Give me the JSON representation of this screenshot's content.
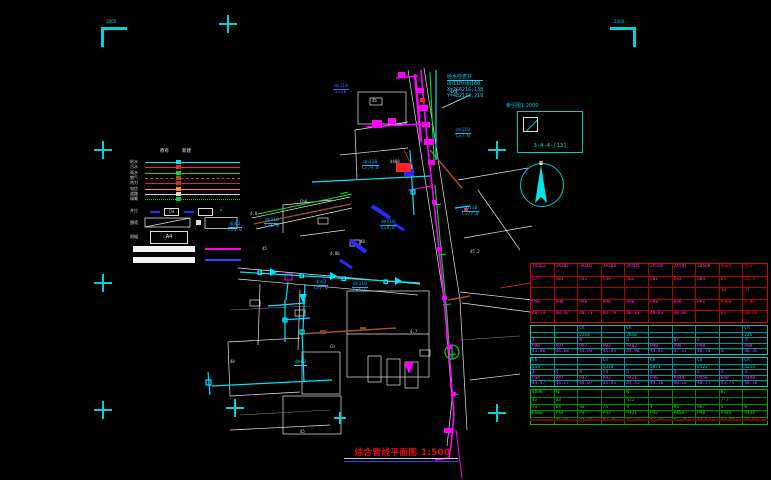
{
  "title": {
    "text": "综合管线平面图 1:500"
  },
  "corner_marks": {
    "tl_text": "2000",
    "tr_text": "2000"
  },
  "index_box": {
    "caption": "索引图1:2000",
    "code": "3-4-4-[13]"
  },
  "coord_block": {
    "line1": "给水检查井",
    "line2": "dn110×dn160",
    "line3": "X=266216.138",
    "line4": "Y=482178.218"
  },
  "colors": {
    "register": "#00d5d5",
    "water": "#ff00ff",
    "existing": "#00e5ff",
    "storm": "#00dd30",
    "table_red": "#e00000",
    "table_cyan": "#00cccc",
    "table_green": "#00bb00",
    "label_blue": "#4466ff"
  },
  "legend": {
    "col_headers": [
      "原有",
      "新建"
    ],
    "rows": [
      {
        "label": "给水",
        "color": "#00e5ff",
        "dash": "solid"
      },
      {
        "label": "污水",
        "color": "#ff2020",
        "dash": "solid"
      },
      {
        "label": "雨水",
        "color": "#00dd30",
        "dash": "solid"
      },
      {
        "label": "燃气",
        "color": "#b05020",
        "dash": "dashed"
      },
      {
        "label": "热力",
        "color": "#d03030",
        "dash": "solid"
      },
      {
        "label": "电信",
        "color": "#ff9020",
        "dash": "solid"
      },
      {
        "label": "道路",
        "color": "#d8d8d8",
        "dash": "solid"
      },
      {
        "label": "绿篱",
        "color": "#00cc40",
        "dash": "dotted"
      }
    ],
    "symbol_row_label": "井位",
    "symbol_box1": "CH",
    "symbol_box2": "",
    "symbol_glyph": "£",
    "wall_label": "围墙",
    "frame_label": "图幅",
    "frame_code": "A4"
  },
  "map_labels": [
    {
      "t": "dn110",
      "s": "L=20",
      "x": 333,
      "y": 84,
      "c": "#4466ff"
    },
    {
      "t": "dn110",
      "s": "L=7.0",
      "x": 455,
      "y": 128,
      "c": "#00b7ff"
    },
    {
      "t": "dn110",
      "s": "L=79.0",
      "x": 362,
      "y": 160,
      "c": "#00b7ff"
    },
    {
      "t": "dn110",
      "s": "L=77.8",
      "x": 462,
      "y": 206,
      "c": "#00b7ff"
    },
    {
      "t": "dn63",
      "s": "L=3.0",
      "x": 228,
      "y": 222,
      "c": "#00b7ff"
    },
    {
      "t": "dn110",
      "s": "L=5.0",
      "x": 264,
      "y": 218,
      "c": "#00b7ff"
    },
    {
      "t": "dn110",
      "s": "L=4.0",
      "x": 380,
      "y": 220,
      "c": "#00b7ff"
    },
    {
      "t": "dn63",
      "s": "L=7.0",
      "x": 314,
      "y": 280,
      "c": "#00b7ff"
    },
    {
      "t": "dn110",
      "s": "L=5.0",
      "x": 352,
      "y": 282,
      "c": "#00b7ff"
    },
    {
      "t": "dn63",
      "s": "",
      "x": 294,
      "y": 360,
      "c": "#00e5ff"
    }
  ],
  "map_texts": [
    {
      "t": "4.8",
      "x": 250,
      "y": 212
    },
    {
      "t": "Ch8",
      "x": 300,
      "y": 200
    },
    {
      "t": "45",
      "x": 262,
      "y": 247
    },
    {
      "t": "4.86",
      "x": 330,
      "y": 252
    },
    {
      "t": "48",
      "x": 360,
      "y": 240
    },
    {
      "t": "d400",
      "x": 390,
      "y": 160
    },
    {
      "t": "4×4",
      "x": 450,
      "y": 90
    },
    {
      "t": "45",
      "x": 300,
      "y": 430
    },
    {
      "t": "48",
      "x": 230,
      "y": 360
    },
    {
      "t": "4.7",
      "x": 410,
      "y": 330
    },
    {
      "t": "Ch",
      "x": 330,
      "y": 345
    },
    {
      "t": "45.2",
      "x": 470,
      "y": 250
    },
    {
      "t": "4b",
      "x": 372,
      "y": 99
    }
  ],
  "table": {
    "sections": [
      {
        "border": "#e00000",
        "grid": "#b00000",
        "row_h": 11.6,
        "text": "#ff30ff",
        "red_cols": [
          8,
          9
        ],
        "red_color": "#ff2020",
        "rows": [
          [
            "JA5Q1",
            "JA5Q2",
            "JA5Q3",
            "JA5Q4",
            "JA5Q5",
            "JA5Q6",
            "JA5Q7",
            "JA5Q8",
            "P502",
            "P51"
          ],
          [
            "577",
            "583",
            "542",
            "549",
            "561",
            "581",
            "583",
            "584",
            "64",
            "25.1"
          ],
          [
            "",
            "",
            "",
            "",
            "",
            "",
            "",
            "",
            "38",
            "21"
          ],
          [
            "P98",
            "P98",
            "P98",
            "P98",
            "P98",
            "P98",
            "P98",
            "P91",
            "A488",
            "4.98"
          ],
          [
            "48.74",
            "48.93",
            "48.73",
            "48.79",
            "48.81",
            "48.82",
            "48.84",
            "",
            "69",
            "48.66"
          ]
        ]
      },
      {
        "border": "#00cccc",
        "grid": "#009999",
        "row_h": 5.6,
        "text": "#ff30ff",
        "cyan_rows": [
          0,
          1
        ],
        "cyan_color": "#00dddd",
        "rows": [
          [
            "",
            "",
            "Ch",
            "",
            "Ch",
            "",
            "",
            "",
            "",
            "Ch"
          ],
          [
            "",
            "",
            "2254",
            "",
            "2650",
            "",
            "",
            "",
            "",
            "225"
          ],
          [
            "4",
            "",
            "4",
            "",
            "4",
            "",
            "W7",
            "4",
            "",
            "大"
          ],
          [
            "P98",
            "P97",
            "P97",
            "P92",
            "P402",
            "P98",
            "P98",
            "P98",
            "",
            "P98"
          ],
          [
            "41.06",
            "44.68",
            "44.84",
            "44.94",
            "44.98",
            "44.41",
            "47.11",
            "48.79",
            "m",
            "48.35"
          ]
        ]
      },
      {
        "border": "#00cccc",
        "grid": "#009999",
        "row_h": 5.6,
        "text": "#ff30ff",
        "cyan_rows": [
          0,
          1
        ],
        "cyan_color": "#00dddd",
        "rows": [
          [
            "Ch",
            "",
            "",
            "Ch",
            "",
            "Ch",
            "",
            "Ch",
            "",
            "Ch"
          ],
          [
            "559",
            "",
            "",
            "5310",
            "",
            "5871",
            "",
            "8522",
            "",
            "5213"
          ],
          [
            "4",
            "4",
            "4",
            "54",
            "4",
            "4",
            "4",
            "4",
            "4",
            "4"
          ],
          [
            "P44",
            "P47",
            "P47",
            "P42",
            "P421",
            "P46",
            "P448",
            "P458",
            "P48",
            "P448"
          ],
          [
            "44.47",
            "44.27",
            "44.07",
            "44.43",
            "44.43",
            "44.10",
            "48.10",
            "48.71",
            "43.74",
            "48.78"
          ]
        ]
      },
      {
        "border": "#00bb00",
        "grid": "#008800",
        "row_h": 6.8,
        "text": "#00ee00",
        "rows": [
          [
            "4898",
            "排",
            "",
            "",
            "W",
            "",
            "",
            "",
            "W7",
            ""
          ],
          [
            "45",
            "D3",
            "",
            "",
            "522",
            "",
            "",
            "",
            "7-3",
            ""
          ],
          [
            "74",
            "64",
            "48",
            "74",
            "4",
            "4",
            "90",
            "987",
            "4",
            "W"
          ],
          [
            "P988",
            "P44",
            "P47",
            "P42",
            "P421",
            "P42",
            "P458",
            "P98",
            "P484",
            "P444"
          ],
          [
            "",
            "46.65",
            "44.96",
            "47.26",
            "47.33",
            "47.24",
            "47.34",
            "47.52",
            "47.48",
            "47.63"
          ]
        ]
      }
    ]
  }
}
